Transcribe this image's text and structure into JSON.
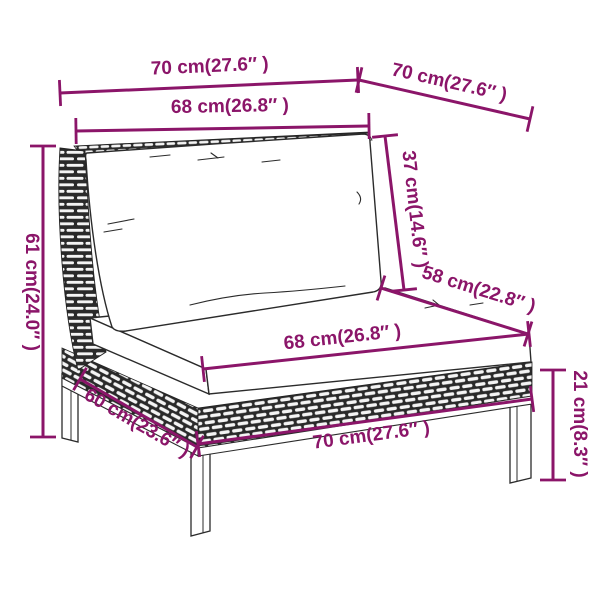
{
  "diagram": {
    "kind": "product-dimension-diagram",
    "subject": "poly rattan garden sofa middle section with cushions",
    "background": "#ffffff",
    "dimension_color": "#8B1569",
    "line_art_color": "#2b2b2b",
    "parts": [
      "wicker-backrest-panel",
      "back-cushion",
      "seat-cushion",
      "wicker-base-apron",
      "legs"
    ]
  },
  "dimensions": [
    {
      "id": "overall-width-top",
      "label": "70 cm(27.6″ )",
      "cm": 70,
      "inches": 27.6
    },
    {
      "id": "overall-depth-top",
      "label": "70 cm(27.6″ )",
      "cm": 70,
      "inches": 27.6
    },
    {
      "id": "back-width",
      "label": "68 cm(26.8″ )",
      "cm": 68,
      "inches": 26.8
    },
    {
      "id": "backrest-height",
      "label": "37 cm(14.6″ )",
      "cm": 37,
      "inches": 14.6
    },
    {
      "id": "seat-depth",
      "label": "58 cm(22.8″ )",
      "cm": 58,
      "inches": 22.8
    },
    {
      "id": "seat-width",
      "label": "68 cm(26.8″ )",
      "cm": 68,
      "inches": 26.8
    },
    {
      "id": "overall-height",
      "label": "61 cm(24.0″ )",
      "cm": 61,
      "inches": 24.0
    },
    {
      "id": "base-depth",
      "label": "60 cm(23.6″ )",
      "cm": 60,
      "inches": 23.6
    },
    {
      "id": "base-width-front",
      "label": "70 cm(27.6″ )",
      "cm": 70,
      "inches": 27.6
    },
    {
      "id": "leg-height",
      "label": "21 cm(8.3″ )",
      "cm": 21,
      "inches": 8.3
    }
  ]
}
